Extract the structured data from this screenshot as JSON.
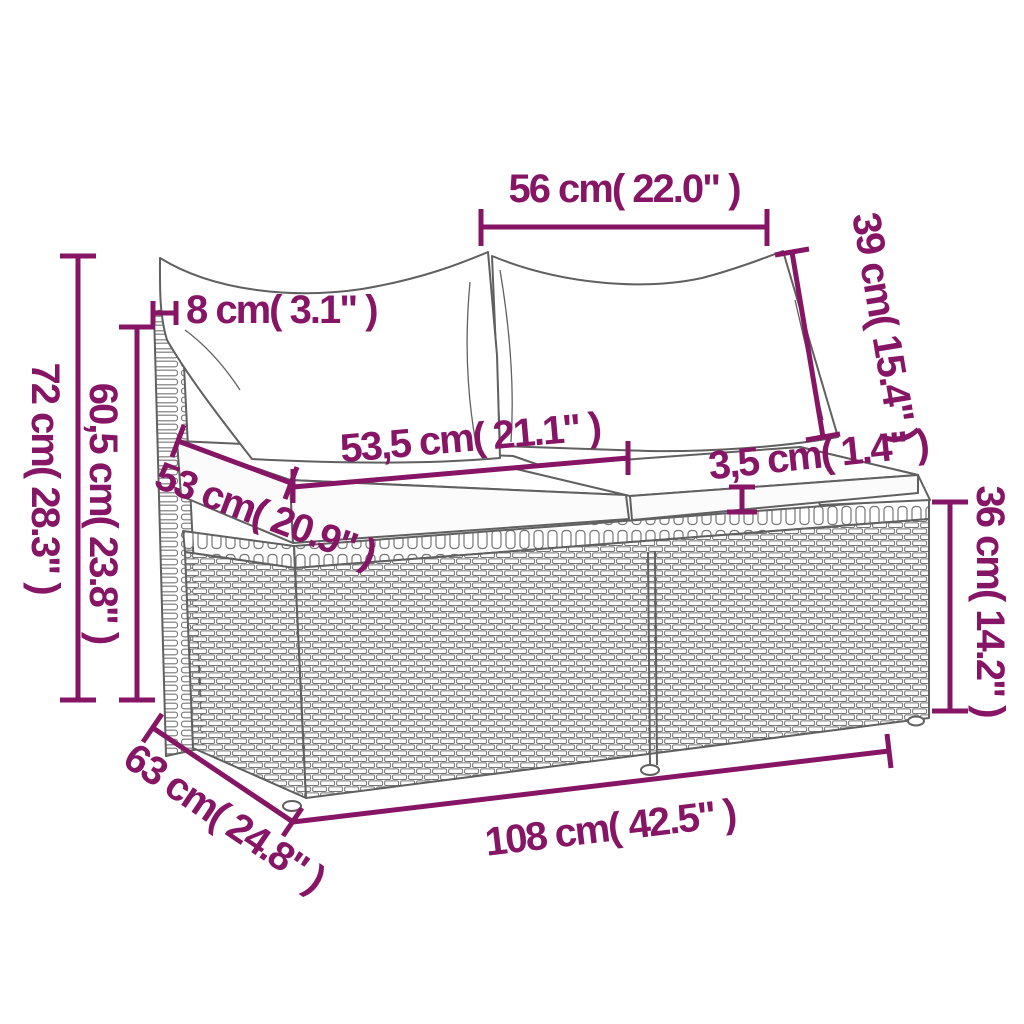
{
  "colors": {
    "dimension_accent": "#871565",
    "line_art_gray": "#606060",
    "background": "#ffffff"
  },
  "diagram": {
    "illustration": "wicker-rattan-sofa-line-drawing-with-cushions",
    "dimensions": {
      "top_width": {
        "label": "56 cm( 22.0\" )",
        "cm": "56",
        "inches": "22.0"
      },
      "pillow_height": {
        "label": "39 cm( 15.4\" )",
        "cm": "39",
        "inches": "15.4"
      },
      "back_thickness": {
        "label": "8 cm( 3.1\" )",
        "cm": "8",
        "inches": "3.1"
      },
      "total_height": {
        "label": "72 cm( 28.3\" )",
        "cm": "72",
        "inches": "28.3"
      },
      "back_height": {
        "label": "60,5 cm( 23.8\" )",
        "cm": "60,5",
        "inches": "23.8"
      },
      "seat_width": {
        "label": "53,5 cm( 21.1\" )",
        "cm": "53,5",
        "inches": "21.1"
      },
      "seat_depth": {
        "label": "53 cm( 20.9\" )",
        "cm": "53",
        "inches": "20.9"
      },
      "cushion_thickness": {
        "label": "3,5 cm( 1.4\" )",
        "cm": "3,5",
        "inches": "1.4"
      },
      "base_height": {
        "label": "36 cm( 14.2\" )",
        "cm": "36",
        "inches": "14.2"
      },
      "depth": {
        "label": "63 cm( 24.8\" )",
        "cm": "63",
        "inches": "24.8"
      },
      "total_width": {
        "label": "108 cm( 42.5\" )",
        "cm": "108",
        "inches": "42.5"
      }
    }
  }
}
